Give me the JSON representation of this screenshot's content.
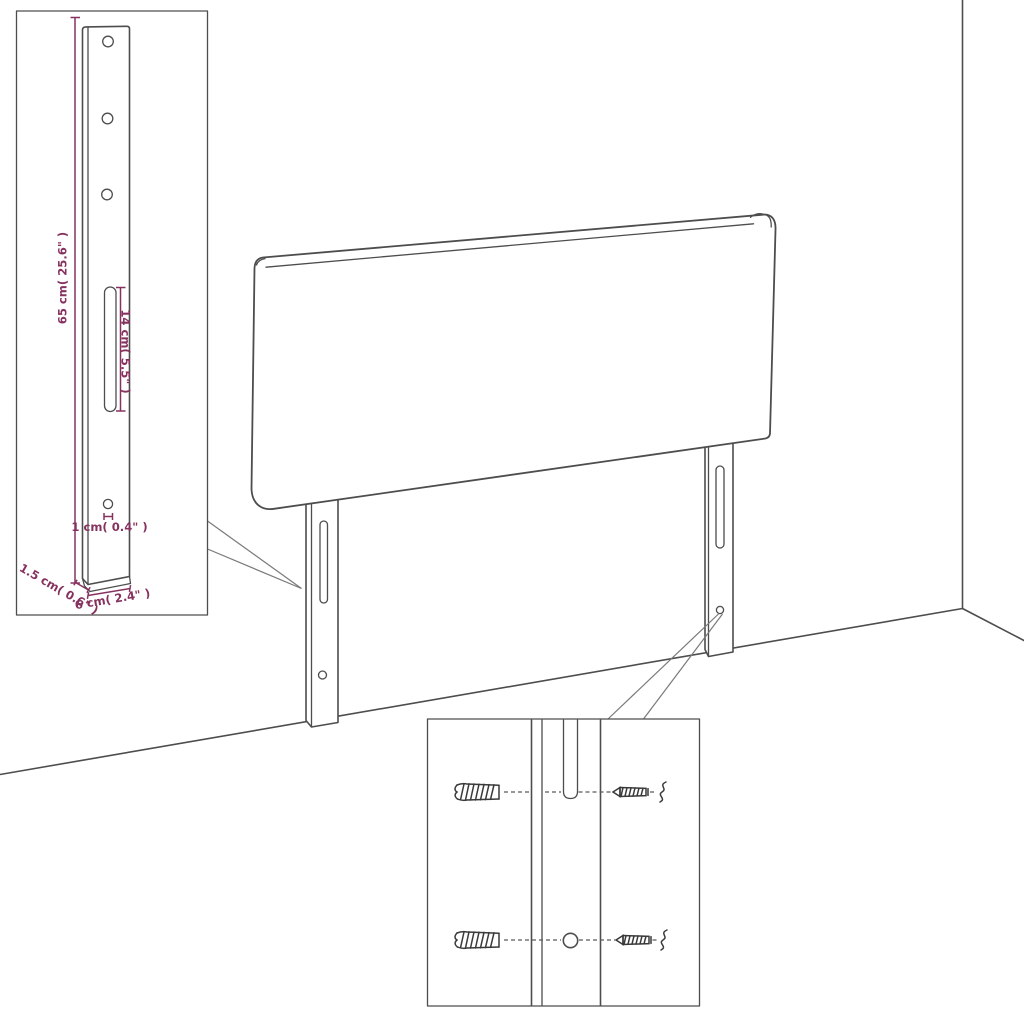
{
  "diagram": {
    "title": "headboard-with-legs-assembly-diagram",
    "colors": {
      "background": "#ffffff",
      "line": "#4d4d4d",
      "dimension": "#86325f"
    },
    "dimension_labels": {
      "leg_height": "65 cm( 25.6\" )",
      "slot_length": "14 cm( 5.5\" )",
      "hole_diameter": "1 cm( 0.4\" )",
      "leg_thickness": "1.5 cm( 0.6\" )",
      "leg_width": "6 cm( 2.4\" )"
    },
    "parts": {
      "panel": "headboard-panel",
      "left_leg": "left-mounting-leg",
      "right_leg": "right-mounting-leg",
      "leg_detail": "leg-dimension-detail",
      "mounting_detail": "wall-anchor-and-screw-detail",
      "anchor": "wall-anchor",
      "screw": "screw"
    }
  }
}
